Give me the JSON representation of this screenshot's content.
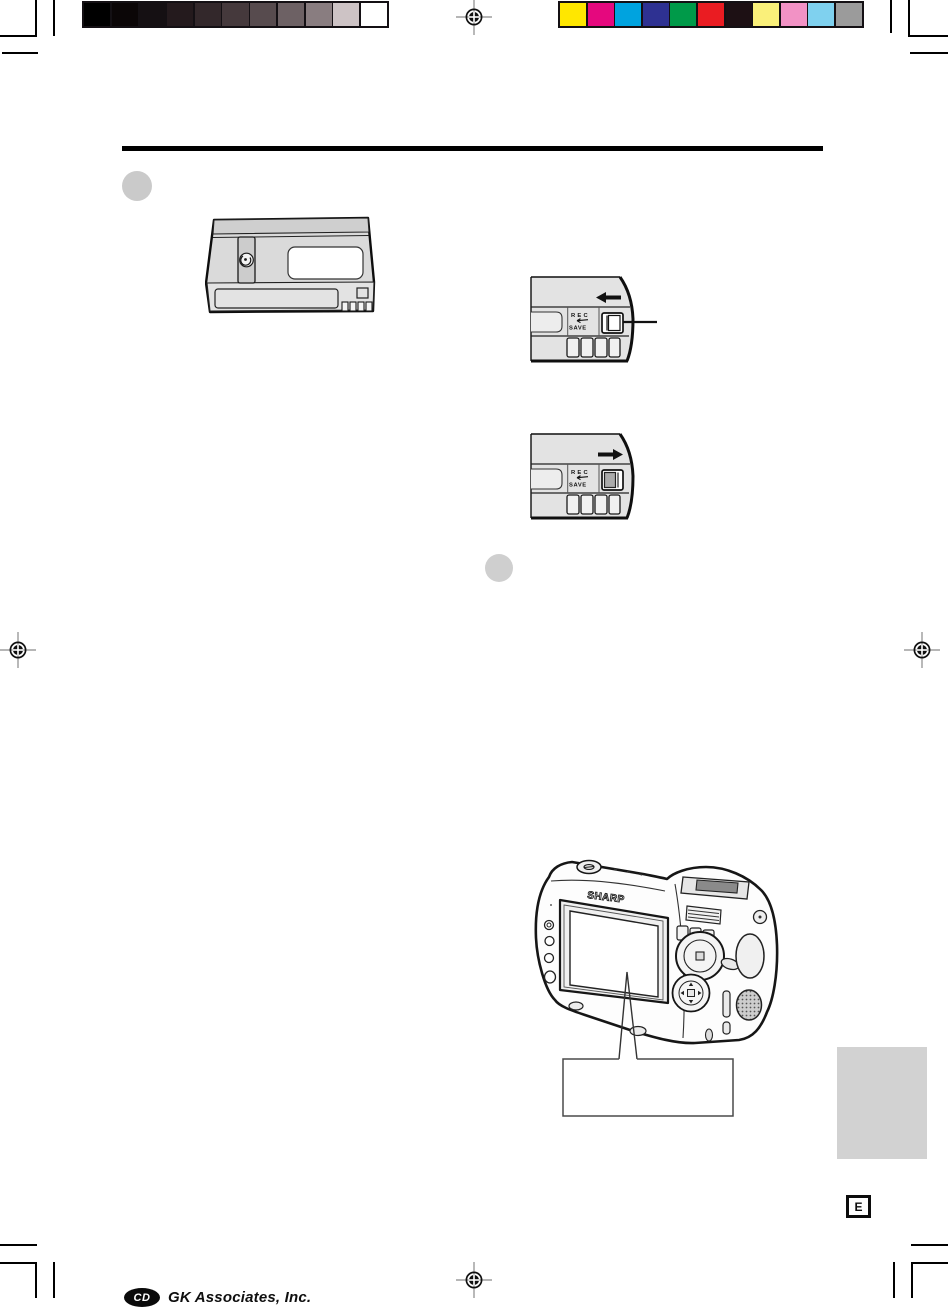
{
  "document": {
    "page_letter_marker": "E"
  },
  "calibration": {
    "grayscale_strip": [
      "#000000",
      "#0b0607",
      "#151013",
      "#241a1d",
      "#33282b",
      "#45393c",
      "#574b4e",
      "#6d6164",
      "#897d80",
      "#cdc3c5",
      "#ffffff"
    ],
    "color_strip": [
      "#ffe700",
      "#e5087e",
      "#00a3df",
      "#2e3192",
      "#009a49",
      "#ea1c22",
      "#1d1014",
      "#faf07a",
      "#f292c5",
      "#7fd1ef",
      "#9b9b9b"
    ]
  },
  "header": {
    "rule_color": "#000000"
  },
  "step_markers": [
    {
      "shape": "circle",
      "color": "#cacaca"
    },
    {
      "shape": "circle",
      "color": "#cfcfcf"
    }
  ],
  "illustrations": {
    "cassette": {
      "name": "videocassette-top-view"
    },
    "record_tab_rec": {
      "rec_label": "REC",
      "save_label": "SAVE",
      "slide_arrow": "left"
    },
    "record_tab_save": {
      "rec_label": "REC",
      "save_label": "SAVE",
      "slide_arrow": "right"
    },
    "camcorder": {
      "brand": "SHARP"
    },
    "callout_box_text": ""
  },
  "side_tab": {
    "color": "#d2d2d2"
  },
  "footer": {
    "logo_monogram": "CD",
    "company": "GK Associates, Inc."
  }
}
